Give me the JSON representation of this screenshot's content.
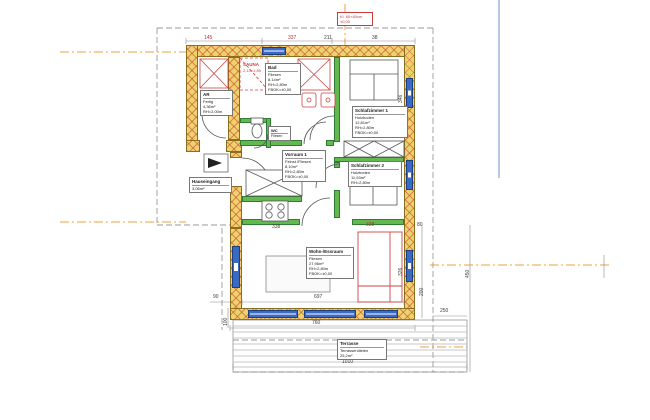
{
  "drawing_type": "floor-plan",
  "rooms": {
    "ar": {
      "name": "AR",
      "l1": "Fertig",
      "l2": "4,36m²",
      "l3": "RH=2,00m"
    },
    "sauna": {
      "name": "SAUNA",
      "l1": "2,13×1,89"
    },
    "bad": {
      "name": "Bad",
      "l1": "Fliesen",
      "l2": "8,14m²",
      "l3": "RH=2,80m",
      "l4": "FBOK=±0,00"
    },
    "schlafzimmer1": {
      "name": "Schlafzimmer 1",
      "l1": "Holzboden",
      "l2": "12,81m²",
      "l3": "RH=2,80m",
      "l4": "FBOK=±0,00"
    },
    "schlafzimmer2": {
      "name": "Schlafzimmer 2",
      "l1": "Holzboden",
      "l2": "11,93m²",
      "l3": "RH=2,80m",
      "l4": "FBOK=±0,00"
    },
    "vorraum": {
      "name": "Vorraum 1",
      "l1": "Feinst./Fliesen",
      "l2": "8,10m²",
      "l3": "RH=2,80m",
      "l4": "FBOK=±0,00"
    },
    "wc": {
      "name": "WC",
      "l1": "Fliesen"
    },
    "wohnessraum": {
      "name": "Wohn-/Essraum",
      "l1": "Fliesen",
      "l2": "27,96m²",
      "l3": "RH=2,80m",
      "l4": "FBOK=±0,00"
    },
    "hauseingang": {
      "name": "Hauseingang",
      "l1": "3,06m²"
    },
    "terrasse": {
      "name": "Terrasse",
      "l1": "Terrassendielen",
      "l2": "25,2m²"
    }
  },
  "annotation_top_right": {
    "l1": "Kl. 60×60cm",
    "l2": "±0,00"
  },
  "dims": {
    "top1": "145",
    "top2": "337",
    "top3": "211",
    "top4": "38",
    "right1": "346",
    "right2": "278",
    "right3": "326",
    "right4": "80",
    "terr_h": "200",
    "terr_w": "250",
    "terr_v": "450",
    "bottom_inner": "697",
    "bottom_outer": "760",
    "bottom_terrace": "1010",
    "left1": "90",
    "left2": "100",
    "kitchen": "338",
    "sofa": "338"
  },
  "colors": {
    "exterior_wall": "#eed26b",
    "partition_wall": "#63b84f",
    "window": "#3a6bc4",
    "axis_line": "#e8a33d",
    "annotation_red": "#cc3a3a",
    "page_divider": "#b9c8e2"
  }
}
